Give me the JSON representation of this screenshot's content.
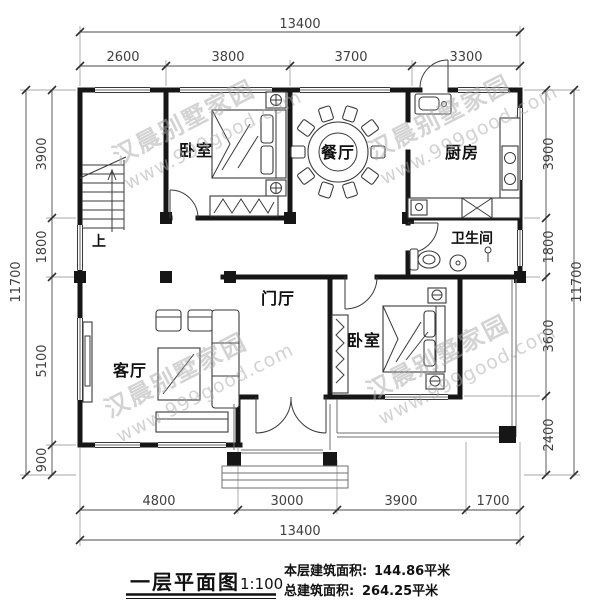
{
  "titleblock": {
    "plan_name": "一层平面图",
    "scale": "1:100",
    "floor_area_label": "本层建筑面积:",
    "floor_area_value": "144.86平米",
    "total_area_label": "总建筑面积:",
    "total_area_value": "264.25平米"
  },
  "rooms": {
    "bedroom1": "卧室",
    "dining": "餐厅",
    "kitchen": "厨房",
    "bathroom": "卫生间",
    "foyer": "门厅",
    "living": "客厅",
    "bedroom2": "卧室",
    "stair_up": "上"
  },
  "dimensions": {
    "top": {
      "total": "13400",
      "segments": [
        "2600",
        "3800",
        "3700",
        "3300"
      ]
    },
    "bottom": {
      "total": "13400",
      "segments": [
        "4800",
        "3000",
        "3900",
        "1700"
      ]
    },
    "left": {
      "total": "11700",
      "segments": [
        "3900",
        "1800",
        "5100",
        "900"
      ]
    },
    "right": {
      "total": "11700",
      "segments": [
        "3900",
        "1800",
        "3600",
        "2400"
      ]
    }
  },
  "watermark": {
    "line1": "汉晨别墅家园",
    "line2": "www.999good.com"
  },
  "colors": {
    "wall": "#161616",
    "dimension_line": "#4a4a4a",
    "watermark": "#a9a9a9",
    "background": "#ffffff"
  }
}
